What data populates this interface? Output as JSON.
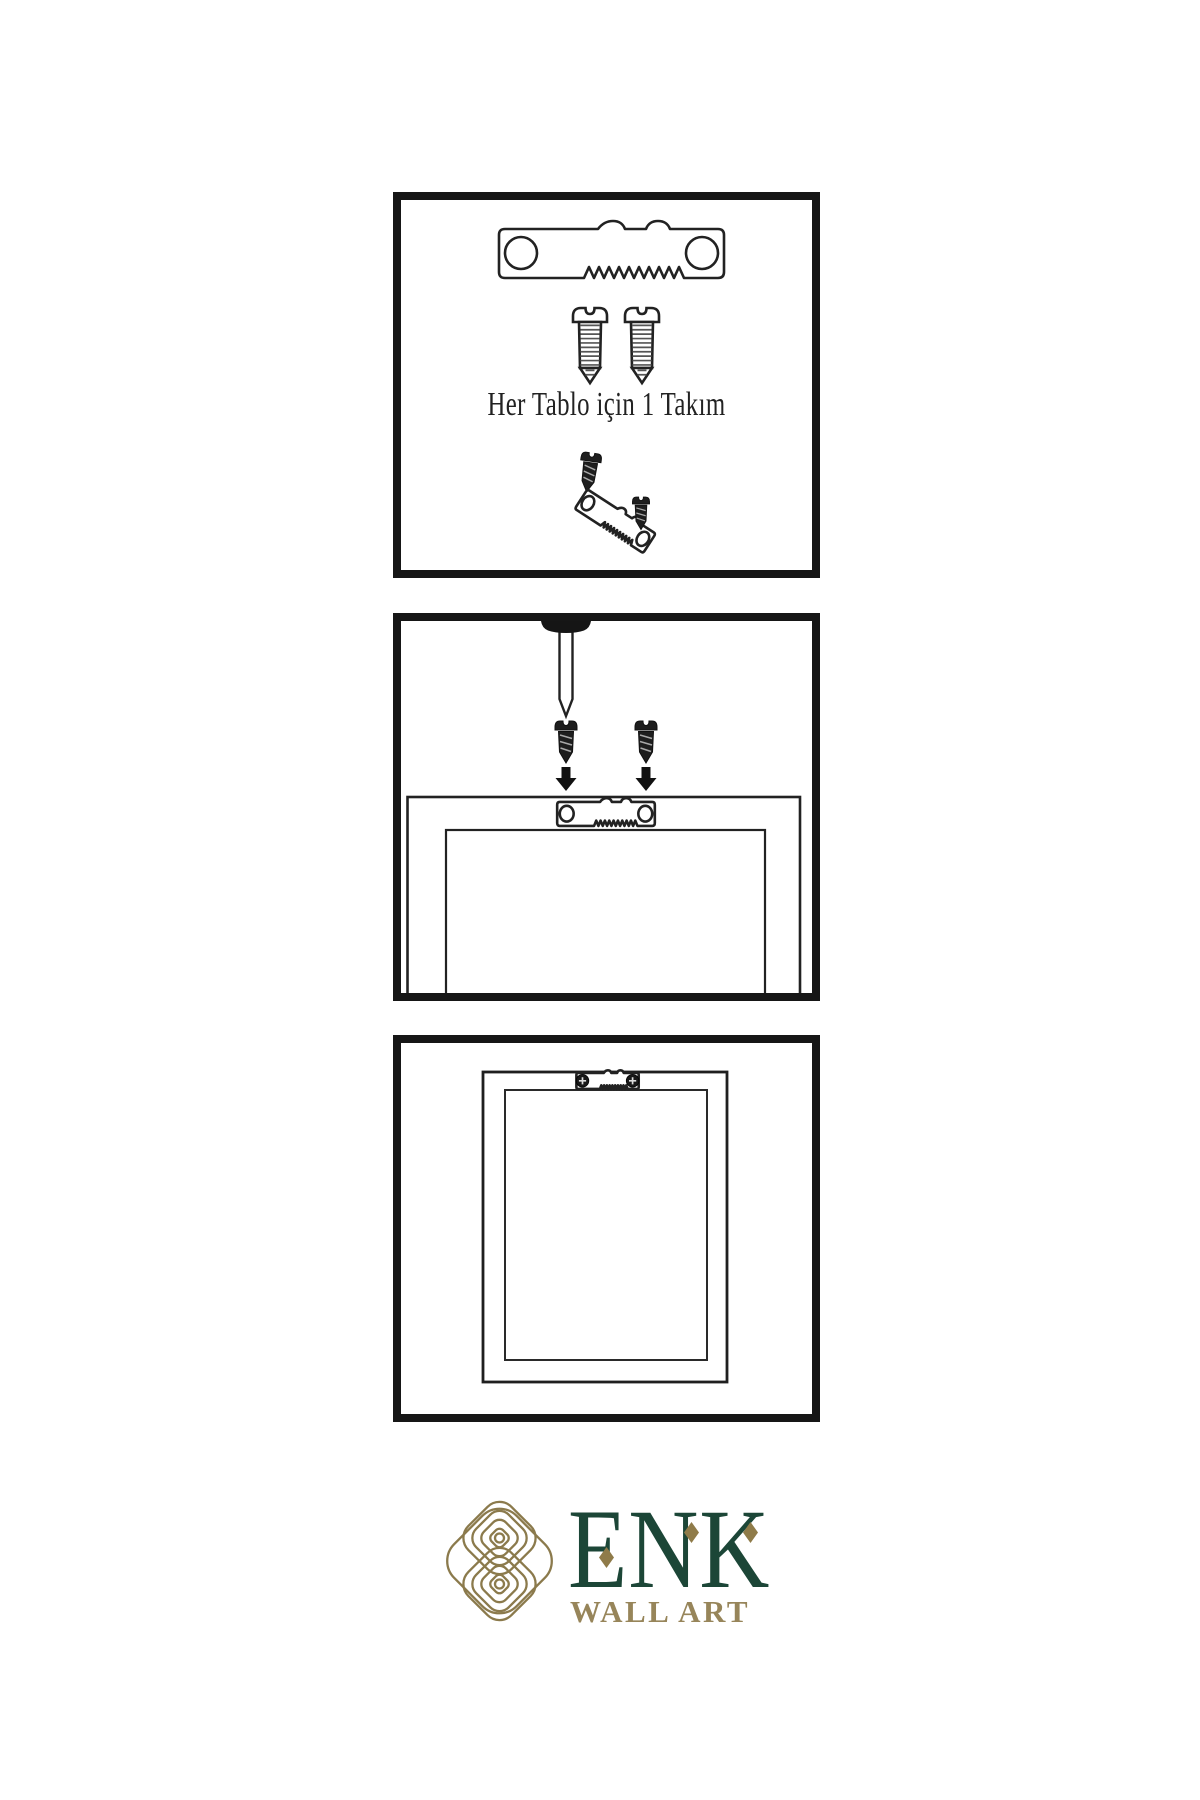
{
  "page": {
    "background": "#ffffff",
    "line_color": "#222222",
    "panel_border_color": "#161616",
    "dark_fill": "#1e1e1e"
  },
  "panels": [
    {
      "name": "hanging-kit-contents",
      "caption": "Her Tablo için 1 Takım",
      "icons": [
        "sawtooth-hanger-icon",
        "screw-icon",
        "screw-icon",
        "dark-screw-icon",
        "tilted-sawtooth-hanger-icon",
        "dark-screw-icon"
      ]
    },
    {
      "name": "screw-hanger-to-frame-step",
      "icons": [
        "nail-icon",
        "dark-screw-icon",
        "dark-screw-icon",
        "down-arrow-icon",
        "down-arrow-icon",
        "sawtooth-hanger-icon",
        "frame-back-icon"
      ]
    },
    {
      "name": "hanger-installed-step",
      "icons": [
        "frame-back-icon",
        "installed-sawtooth-hanger-icon",
        "phillips-screw-head-icon",
        "phillips-screw-head-icon"
      ]
    }
  ],
  "brand": {
    "name": "ENK",
    "tagline": "WALL ART",
    "logo_icon": "knot-icon",
    "colors": {
      "green": "#1c4637",
      "knot_gold": "#8b7a4c",
      "tagline_gold": "#97855a",
      "diamond_gold": "#8f7b49"
    }
  }
}
